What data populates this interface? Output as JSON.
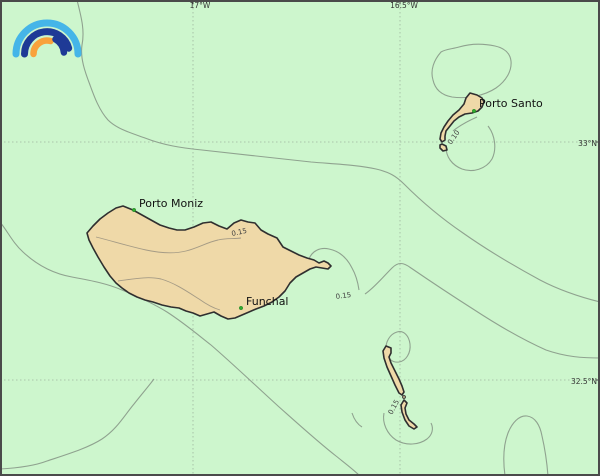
{
  "map": {
    "title": "Madeira archipelago map",
    "colors": {
      "sea": "#cdf6cd",
      "island_fill": "#efd9a8",
      "island_stroke": "#2f2f2f",
      "contour_line": "#8fa28f",
      "grid_line": "#9fb49f",
      "frame": "#4a4a4a",
      "place_marker": "#2faa2f"
    }
  },
  "axis": {
    "top_labels": [
      {
        "label": "17°W"
      },
      {
        "label": "16.5°W"
      }
    ],
    "right_labels": [
      {
        "label": "33°N"
      },
      {
        "label": "32.5°N"
      }
    ]
  },
  "places": [
    {
      "name": "Porto Moniz"
    },
    {
      "name": "Funchal"
    },
    {
      "name": "Porto Santo"
    }
  ],
  "contour_labels": [
    {
      "value": "0.15"
    },
    {
      "value": "0.15"
    },
    {
      "value": "0.10"
    },
    {
      "value": "0.15"
    }
  ],
  "logo": {
    "name": "rainbow-logo",
    "colors": {
      "outer_arc": "#45b5e8",
      "middle_arc": "#1e3a96",
      "inner_left_arc": "#f9a23b",
      "inner_right_arc": "#1e3a96"
    }
  }
}
